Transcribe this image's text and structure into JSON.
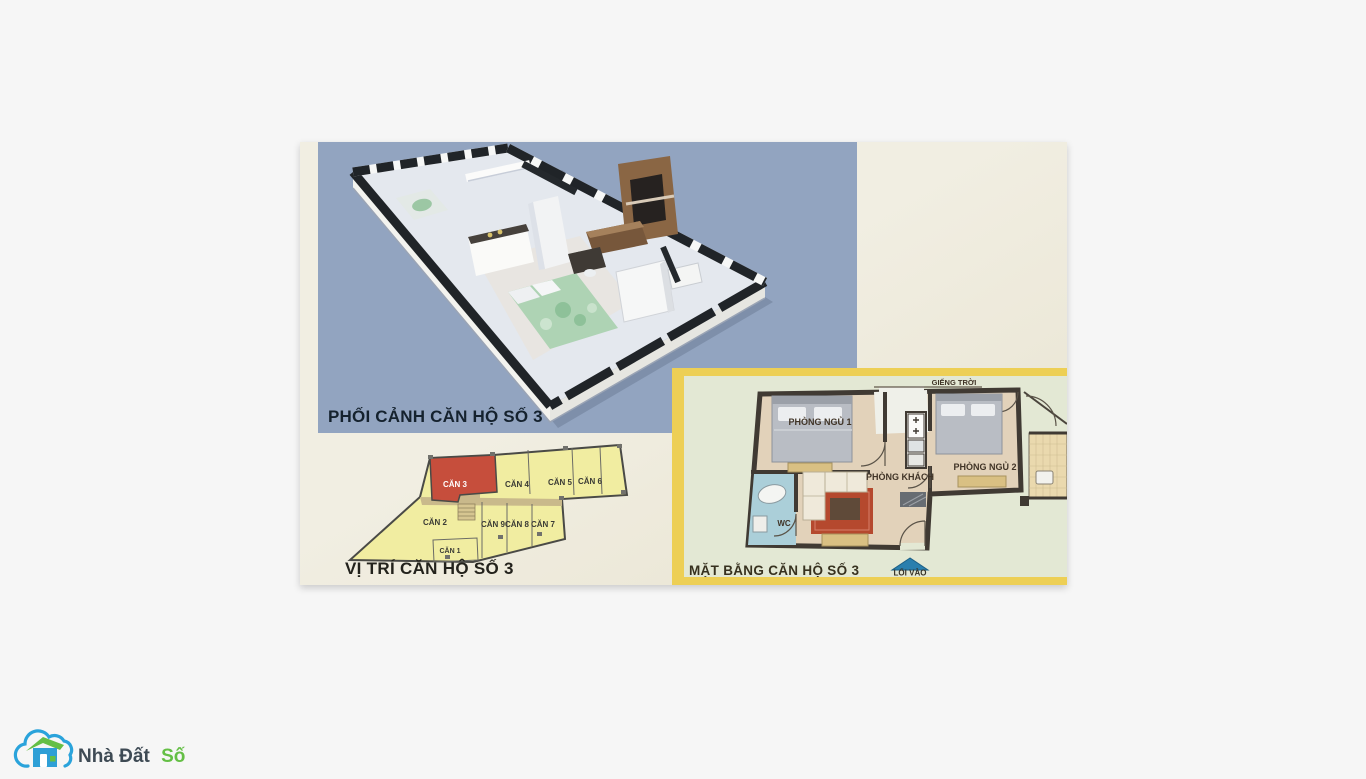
{
  "brand": {
    "name_primary": "Nhà Đất",
    "name_accent": "Số",
    "blue": "#2aa3db",
    "green": "#64bf45",
    "text_dark": "#3e4a54"
  },
  "perspective": {
    "label": "PHỐI CẢNH CĂN HỘ SỐ 3",
    "panel_color": "#92a4c0"
  },
  "location": {
    "label": "VỊ TRÍ CĂN HỘ SỐ 3",
    "highlighted_unit": "CĂN 3",
    "highlight_color": "#c64e3c",
    "unit_fill_color": "#f1eda1",
    "units": {
      "u1": "CĂN 1",
      "u2": "CĂN 2",
      "u3": "CĂN 3",
      "u4": "CĂN 4",
      "u5": "CĂN 5",
      "u6": "CĂN 6",
      "u7": "CĂN 7",
      "u8": "CĂN 8",
      "u9": "CĂN 9"
    }
  },
  "floorplan": {
    "label": "MẶT BẰNG CĂN HỘ SỐ 3",
    "skylight": "GIẾNG TRỜI",
    "entrance": "LỐI VÀO",
    "frame_color": "#edcf55",
    "entrance_arrow_color": "#2a7fae",
    "rooms": {
      "bedroom1": "PHÒNG NGỦ 1",
      "bedroom2": "PHÒNG NGỦ 2",
      "living": "PHÒNG KHÁCH",
      "wc": "WC"
    }
  }
}
